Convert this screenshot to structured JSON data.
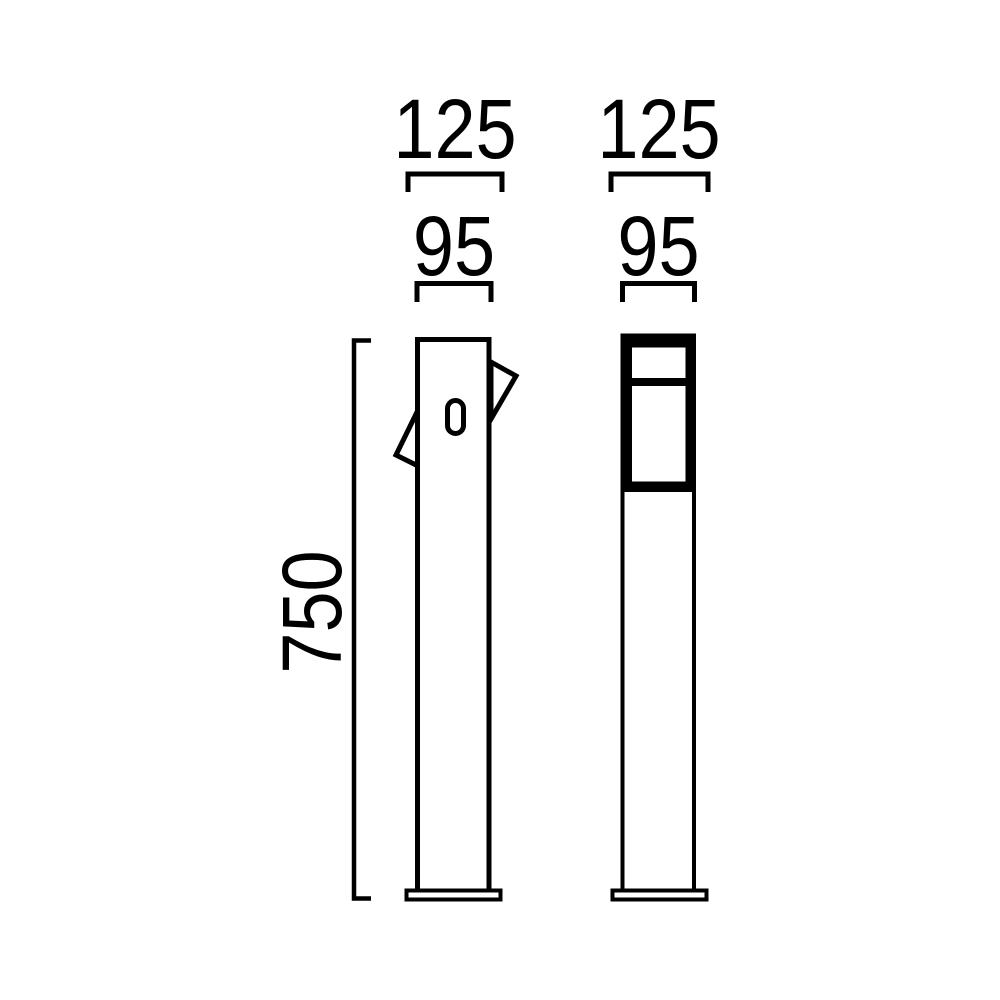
{
  "background_color": "#ffffff",
  "line_color": "#000000",
  "drawing_type": "bollard-luminaire-dimension-drawing",
  "views": {
    "side": {
      "labels": {
        "base_width": "125",
        "body_width": "95",
        "height": "750"
      }
    },
    "front": {
      "labels": {
        "base_width": "125",
        "body_width": "95"
      }
    }
  }
}
